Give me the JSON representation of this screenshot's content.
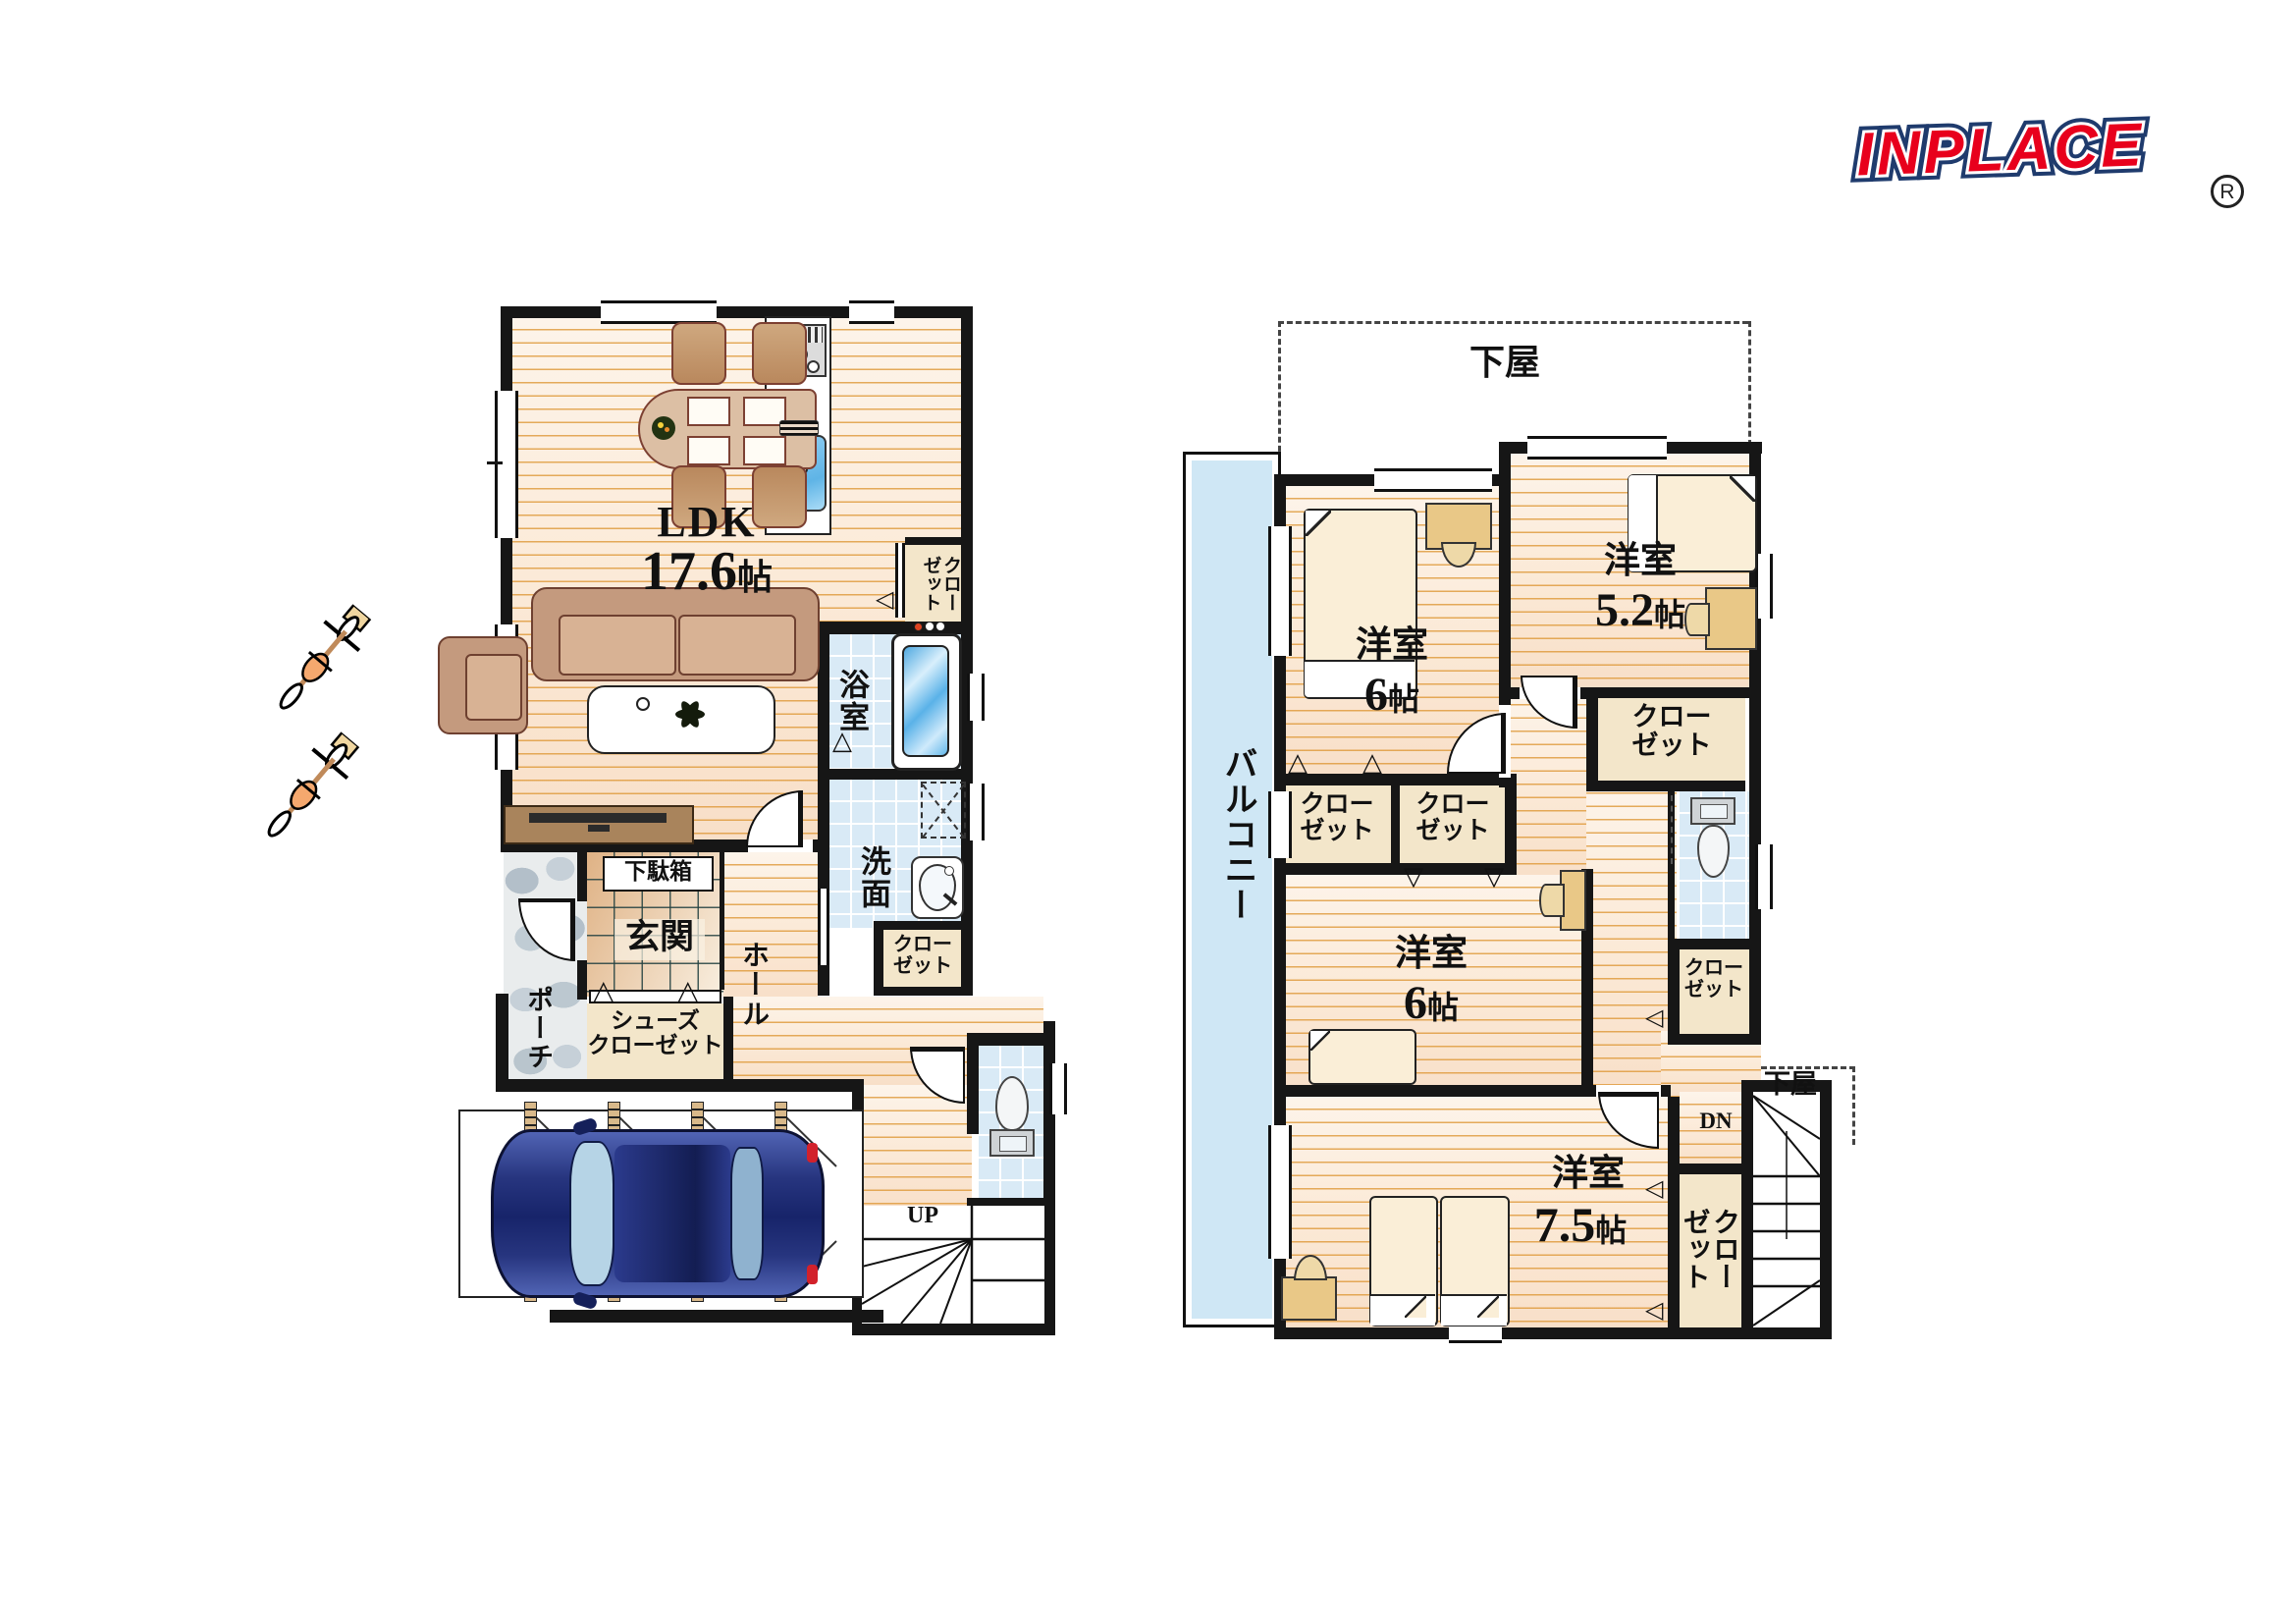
{
  "logo": {
    "brand": "INPLACE",
    "registered": "R"
  },
  "floor1": {
    "ldk_label": "LDK",
    "ldk_size": "17.6",
    "ldk_unit": "帖",
    "bath": "浴室",
    "washroom": "洗面",
    "hall": "ホール",
    "genkan": "玄関",
    "porch": "ポーチ",
    "getabako": "下駄箱",
    "shoes_closet_line1": "シューズ",
    "shoes_closet_line2": "クローゼット",
    "closet_ldk": "クローゼット",
    "closet_wash": "クローゼット",
    "stairs_up": "UP"
  },
  "floor2": {
    "geya_top": "下屋",
    "geya_bottom": "下屋",
    "balcony": "バルコニー",
    "room_nw_label": "洋室",
    "room_nw_size": "6",
    "room_nw_unit": "帖",
    "room_ne_label": "洋室",
    "room_ne_size": "5.2",
    "room_ne_unit": "帖",
    "room_mid_label": "洋室",
    "room_mid_size": "6",
    "room_mid_unit": "帖",
    "room_s_label": "洋室",
    "room_s_size": "7.5",
    "room_s_unit": "帖",
    "closet_a": "クローゼット",
    "closet_b": "クローゼット",
    "closet_ne": "クローゼット",
    "closet_e": "クローゼット",
    "closet_s": "クローゼット",
    "stairs_dn": "DN"
  }
}
